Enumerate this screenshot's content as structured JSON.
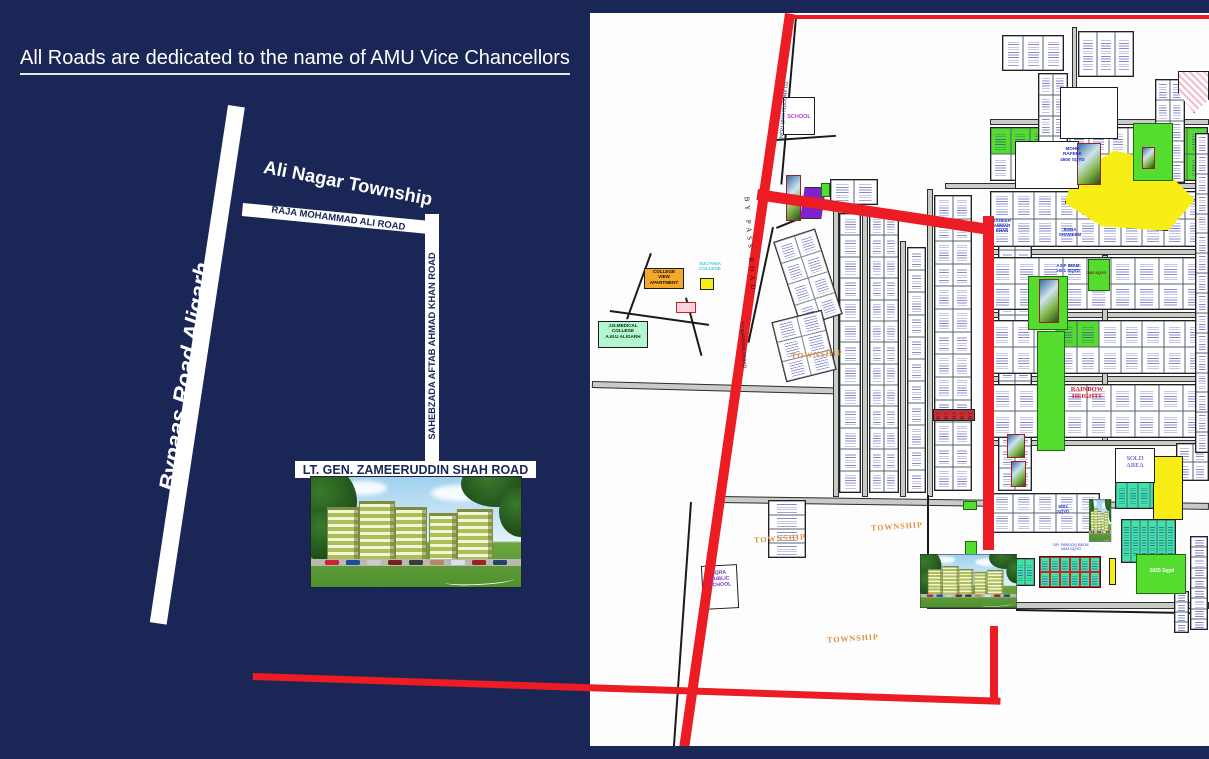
{
  "title": "All Roads are dedicated to the name of AMU Vice Chancellors",
  "colors": {
    "navy_background": "#1a2656",
    "road_red": "#ec1c24",
    "plot_green": "#54dd2e",
    "plot_teal": "#3fe3a6",
    "plot_yellow": "#f8ee16",
    "plot_purple": "#7d22cc",
    "township_label": "#dd8f3d"
  },
  "left_panel": {
    "bypass_road_label": "Bypaas Road Aligarh",
    "township_label": "Ali Nagar Township",
    "raja_road_label": "RAJA MOHAMMAD ALI ROAD",
    "sahebzada_road_label": "SAHEBZADA AFTAB AHMAD KHAN ROAD",
    "ltgen_road_label": "LT. GEN. ZAMEERUDDIN SHAH ROAD"
  },
  "map": {
    "streets": [
      [
        2,
        368,
        244,
        7,
        1.5
      ],
      [
        128,
        483,
        491,
        7,
        0.8
      ],
      [
        337,
        589,
        282,
        7,
        0
      ],
      [
        243,
        194,
        6,
        290,
        0
      ],
      [
        272,
        194,
        6,
        290,
        0
      ],
      [
        310,
        228,
        6,
        256,
        0
      ],
      [
        337,
        176,
        6,
        308,
        0
      ],
      [
        400,
        106,
        219,
        6,
        0
      ],
      [
        355,
        170,
        264,
        6,
        0
      ],
      [
        400,
        236,
        219,
        6,
        0
      ],
      [
        400,
        299,
        219,
        6,
        0
      ],
      [
        400,
        363,
        219,
        6,
        0
      ],
      [
        400,
        427,
        219,
        6,
        0
      ],
      [
        512,
        242,
        6,
        186,
        0
      ],
      [
        482,
        14,
        5,
        94,
        0
      ]
    ],
    "black_lines": [
      [
        205,
        4,
        2,
        168,
        5
      ],
      [
        100,
        489,
        2,
        248,
        4
      ],
      [
        426,
        596,
        178,
        2,
        1
      ],
      [
        337,
        482,
        2,
        64,
        0
      ],
      [
        186,
        214,
        58,
        2,
        -22
      ],
      [
        182,
        214,
        2,
        118,
        12
      ],
      [
        186,
        126,
        60,
        2,
        -4
      ],
      [
        20,
        297,
        100,
        2,
        8
      ],
      [
        60,
        240,
        2,
        70,
        20
      ],
      [
        95,
        285,
        2,
        60,
        -15
      ]
    ],
    "red_roads": [
      [
        195,
        2,
        424,
        4,
        0
      ],
      [
        195,
        0,
        10,
        742,
        8.2
      ],
      [
        168,
        176,
        236,
        11,
        8.6
      ],
      [
        393,
        203,
        11,
        334,
        0
      ]
    ],
    "red_links": [
      [
        253,
        673,
        748,
        7,
        1.9
      ],
      [
        990,
        626,
        8,
        78,
        0
      ]
    ],
    "blocks": [
      {
        "x": 249,
        "y": 200,
        "w": 22,
        "h": 280,
        "c": 1,
        "r": 13
      },
      {
        "x": 279,
        "y": 200,
        "w": 30,
        "h": 280,
        "c": 2,
        "r": 13
      },
      {
        "x": 317,
        "y": 234,
        "w": 19,
        "h": 246,
        "c": 1,
        "r": 11
      },
      {
        "x": 344,
        "y": 182,
        "w": 38,
        "h": 296,
        "c": 2,
        "r": 13
      },
      {
        "x": 408,
        "y": 214,
        "w": 34,
        "h": 264,
        "c": 2,
        "r": 12
      },
      {
        "x": 400,
        "y": 114,
        "w": 218,
        "h": 54,
        "c": 11,
        "r": 2,
        "g": [
          0,
          1,
          2,
          9,
          10,
          20,
          21
        ]
      },
      {
        "x": 400,
        "y": 178,
        "w": 218,
        "h": 56,
        "c": 10,
        "r": 2
      },
      {
        "x": 400,
        "y": 244,
        "w": 218,
        "h": 53,
        "c": 9,
        "r": 2
      },
      {
        "x": 400,
        "y": 307,
        "w": 218,
        "h": 54,
        "c": 10,
        "r": 2,
        "g": [
          3,
          4
        ]
      },
      {
        "x": 400,
        "y": 371,
        "w": 218,
        "h": 54,
        "c": 9,
        "r": 2
      },
      {
        "x": 448,
        "y": 60,
        "w": 30,
        "h": 106,
        "c": 2,
        "r": 5
      },
      {
        "x": 565,
        "y": 66,
        "w": 30,
        "h": 104,
        "c": 2,
        "r": 5
      },
      {
        "x": 488,
        "y": 18,
        "w": 56,
        "h": 46,
        "c": 3,
        "r": 1
      },
      {
        "x": 412,
        "y": 22,
        "w": 62,
        "h": 36,
        "c": 3,
        "r": 1
      },
      {
        "x": 525,
        "y": 468,
        "w": 58,
        "h": 28,
        "c": 5,
        "r": 1,
        "kind": "teal"
      },
      {
        "x": 531,
        "y": 506,
        "w": 55,
        "h": 44,
        "c": 6,
        "r": 1,
        "kind": "teal"
      },
      {
        "x": 425,
        "y": 545,
        "w": 20,
        "h": 28,
        "c": 2,
        "r": 1,
        "kind": "teal"
      },
      {
        "x": 449,
        "y": 543,
        "w": 62,
        "h": 32,
        "c": 6,
        "r": 2,
        "kind": "mixed"
      },
      {
        "x": 600,
        "y": 523,
        "w": 18,
        "h": 94,
        "c": 1,
        "r": 9
      },
      {
        "x": 584,
        "y": 578,
        "w": 15,
        "h": 42,
        "c": 1,
        "r": 4
      },
      {
        "x": 178,
        "y": 487,
        "w": 38,
        "h": 58,
        "c": 1,
        "r": 4
      },
      {
        "x": 196,
        "y": 220,
        "w": 44,
        "h": 90,
        "c": 2,
        "r": 4,
        "rot": -18
      },
      {
        "x": 240,
        "y": 166,
        "w": 48,
        "h": 26,
        "c": 2,
        "r": 1
      },
      {
        "x": 586,
        "y": 430,
        "w": 33,
        "h": 38,
        "c": 2,
        "r": 2
      },
      {
        "x": 343,
        "y": 396,
        "w": 42,
        "h": 12,
        "c": 5,
        "r": 1,
        "kind": "shops"
      },
      {
        "x": 188,
        "y": 302,
        "w": 52,
        "h": 62,
        "c": 2,
        "r": 3,
        "rot": -14
      },
      {
        "x": 400,
        "y": 480,
        "w": 110,
        "h": 40,
        "c": 5,
        "r": 2
      },
      {
        "x": 605,
        "y": 120,
        "w": 14,
        "h": 320,
        "c": 1,
        "r": 16
      }
    ],
    "areas": [
      {
        "kind": "yellow",
        "x": 475,
        "y": 136,
        "w": 130,
        "h": 82,
        "clip": "polygon(6% 32%, 38% 2%, 68% 12%, 100% 62%, 79% 100%, 28% 94%, 0 66%)"
      },
      {
        "kind": "yellow",
        "x": 563,
        "y": 443,
        "w": 30,
        "h": 64
      },
      {
        "kind": "yellow",
        "x": 519,
        "y": 545,
        "w": 7,
        "h": 27
      },
      {
        "kind": "pinkhatch",
        "x": 588,
        "y": 58,
        "w": 31,
        "h": 42,
        "clip": "polygon(0 0,100% 0,100% 68%,52% 100%,0 52%)"
      },
      {
        "kind": "purple",
        "x": 210,
        "y": 174,
        "w": 26,
        "h": 32,
        "clip": "polygon(18% 0,100% 0,82% 100%,0 100%)"
      },
      {
        "kind": "mint",
        "x": 8,
        "y": 308,
        "w": 50,
        "h": 27
      },
      {
        "kind": "orange",
        "x": 54,
        "y": 255,
        "w": 40,
        "h": 21
      },
      {
        "kind": "yellow",
        "x": 110,
        "y": 265,
        "w": 14,
        "h": 12
      },
      {
        "kind": "pinksmall",
        "x": 86,
        "y": 289,
        "w": 20,
        "h": 11
      },
      {
        "kind": "green",
        "x": 447,
        "y": 318,
        "w": 28,
        "h": 120
      },
      {
        "kind": "green",
        "x": 438,
        "y": 263,
        "w": 40,
        "h": 54
      },
      {
        "kind": "green",
        "x": 498,
        "y": 246,
        "w": 22,
        "h": 32
      },
      {
        "kind": "green",
        "x": 546,
        "y": 541,
        "w": 50,
        "h": 40
      },
      {
        "kind": "green",
        "x": 543,
        "y": 110,
        "w": 40,
        "h": 58
      },
      {
        "kind": "green",
        "x": 231,
        "y": 170,
        "w": 9,
        "h": 14
      },
      {
        "kind": "green",
        "x": 373,
        "y": 488,
        "w": 14,
        "h": 9
      },
      {
        "kind": "green",
        "x": 375,
        "y": 528,
        "w": 12,
        "h": 14
      },
      {
        "kind": "white",
        "x": 193,
        "y": 84,
        "w": 32,
        "h": 38
      },
      {
        "kind": "white",
        "x": 112,
        "y": 552,
        "w": 36,
        "h": 44,
        "rot": -3
      },
      {
        "kind": "white",
        "x": 525,
        "y": 435,
        "w": 40,
        "h": 35
      },
      {
        "kind": "white",
        "x": 425,
        "y": 128,
        "w": 64,
        "h": 48
      },
      {
        "kind": "white",
        "x": 470,
        "y": 74,
        "w": 58,
        "h": 52
      },
      {
        "kind": "photo",
        "x": 449,
        "y": 266,
        "w": 20,
        "h": 44
      },
      {
        "kind": "photo",
        "x": 417,
        "y": 421,
        "w": 18,
        "h": 24
      },
      {
        "kind": "photo",
        "x": 421,
        "y": 448,
        "w": 15,
        "h": 26
      },
      {
        "kind": "photo",
        "x": 487,
        "y": 130,
        "w": 24,
        "h": 42
      },
      {
        "kind": "photo",
        "x": 552,
        "y": 134,
        "w": 13,
        "h": 22
      },
      {
        "kind": "photo",
        "x": 196,
        "y": 162,
        "w": 15,
        "h": 46
      }
    ],
    "labels": [
      {
        "t": "SCHOOL",
        "x": 193,
        "y": 101,
        "w": 32,
        "s": 5.5,
        "c": "#b23ecf",
        "b": 1
      },
      {
        "t": "TO ANOOPSHAHR ROAD",
        "x": 132,
        "y": 95,
        "w": 120,
        "s": 5,
        "c": "#10225a",
        "r": 95
      },
      {
        "t": "BY PASS ROAD",
        "x": 85,
        "y": 228,
        "w": 150,
        "s": 7,
        "c": "#111111",
        "r": 86,
        "f": "serif",
        "ls": 4
      },
      {
        "t": "TO BARRAULI ROAD",
        "x": 92,
        "y": 329,
        "w": 120,
        "s": 4.8,
        "c": "#222222",
        "r": 86
      },
      {
        "t": "SULTANIA\nCOLLEGE",
        "x": 100,
        "y": 248,
        "w": 40,
        "s": 4.5,
        "c": "#45c8de",
        "b": 1
      },
      {
        "t": "COLLEGE\nVIEW\nAPARTMENT",
        "x": 54,
        "y": 256,
        "w": 40,
        "s": 4.6,
        "c": "#111111",
        "b": 1
      },
      {
        "t": "J.N.MEDICAL\nCOLLEGE\nA.M.U ALIGARH",
        "x": 8,
        "y": 310,
        "w": 50,
        "s": 4.6,
        "c": "#0a2a0a",
        "b": 1
      },
      {
        "t": "TOWNSHIP",
        "x": 195,
        "y": 337,
        "w": 64,
        "s": 8,
        "c": "#dd8f3d",
        "r": -4,
        "f": "serif",
        "b": 1,
        "ls": 1
      },
      {
        "t": "TOWNSHIP",
        "x": 275,
        "y": 509,
        "w": 64,
        "s": 8,
        "c": "#dd8f3d",
        "r": -4,
        "f": "serif",
        "b": 1,
        "ls": 1
      },
      {
        "t": "TOWNSHIP",
        "x": 158,
        "y": 521,
        "w": 64,
        "s": 8,
        "c": "#dd8f3d",
        "r": -4,
        "f": "serif",
        "b": 1,
        "ls": 1
      },
      {
        "t": "TOWNSHIP",
        "x": 231,
        "y": 621,
        "w": 64,
        "s": 8,
        "c": "#dd8f3d",
        "r": -4,
        "f": "serif",
        "b": 1,
        "ls": 1
      },
      {
        "t": "RAINBOW\nHEIGHTS",
        "x": 476,
        "y": 373,
        "w": 42,
        "s": 6.5,
        "c": "#e01020",
        "b": 1,
        "f": "serif"
      },
      {
        "t": "SOLD\nAREA",
        "x": 528,
        "y": 442,
        "w": 34,
        "s": 6.5,
        "c": "#2a3bbf",
        "f": "serif"
      },
      {
        "t": "IQRA\nPUBLIC\nSCHOOL",
        "x": 112,
        "y": 558,
        "w": 36,
        "s": 5.2,
        "c": "#7a35c0",
        "b": 1,
        "r": -3
      },
      {
        "t": "MOHD\nRAFEEK\n4500 SQYD",
        "x": 455,
        "y": 133,
        "w": 55,
        "s": 4.6,
        "c": "#2233cc",
        "b": 1
      },
      {
        "t": "ZAHEER\nANWAR\nKHAN",
        "x": 392,
        "y": 205,
        "w": 40,
        "s": 4.4,
        "c": "#2233cc",
        "b": 1
      },
      {
        "t": "RANA\nSHAMEEM",
        "x": 458,
        "y": 214,
        "w": 44,
        "s": 4.4,
        "c": "#2233cc",
        "b": 1
      },
      {
        "t": "ASIF IMAM\n2001 SQYD",
        "x": 454,
        "y": 250,
        "w": 48,
        "s": 4.4,
        "c": "#2233cc",
        "b": 1
      },
      {
        "t": "1500 SQYD",
        "x": 494,
        "y": 258,
        "w": 24,
        "s": 3.8,
        "c": "#8a1111",
        "b": 1
      },
      {
        "t": "2025 Sqyd",
        "x": 550,
        "y": 556,
        "w": 44,
        "s": 5,
        "c": "#ffffff",
        "b": 1
      },
      {
        "t": "8004\nSQYD",
        "x": 458,
        "y": 492,
        "w": 30,
        "s": 4.2,
        "c": "#2233cc",
        "b": 1
      },
      {
        "t": "DR. FAROOQ BEGA\n3443 SQYD",
        "x": 456,
        "y": 530,
        "w": 50,
        "s": 3.8,
        "c": "#2233cc"
      }
    ]
  }
}
